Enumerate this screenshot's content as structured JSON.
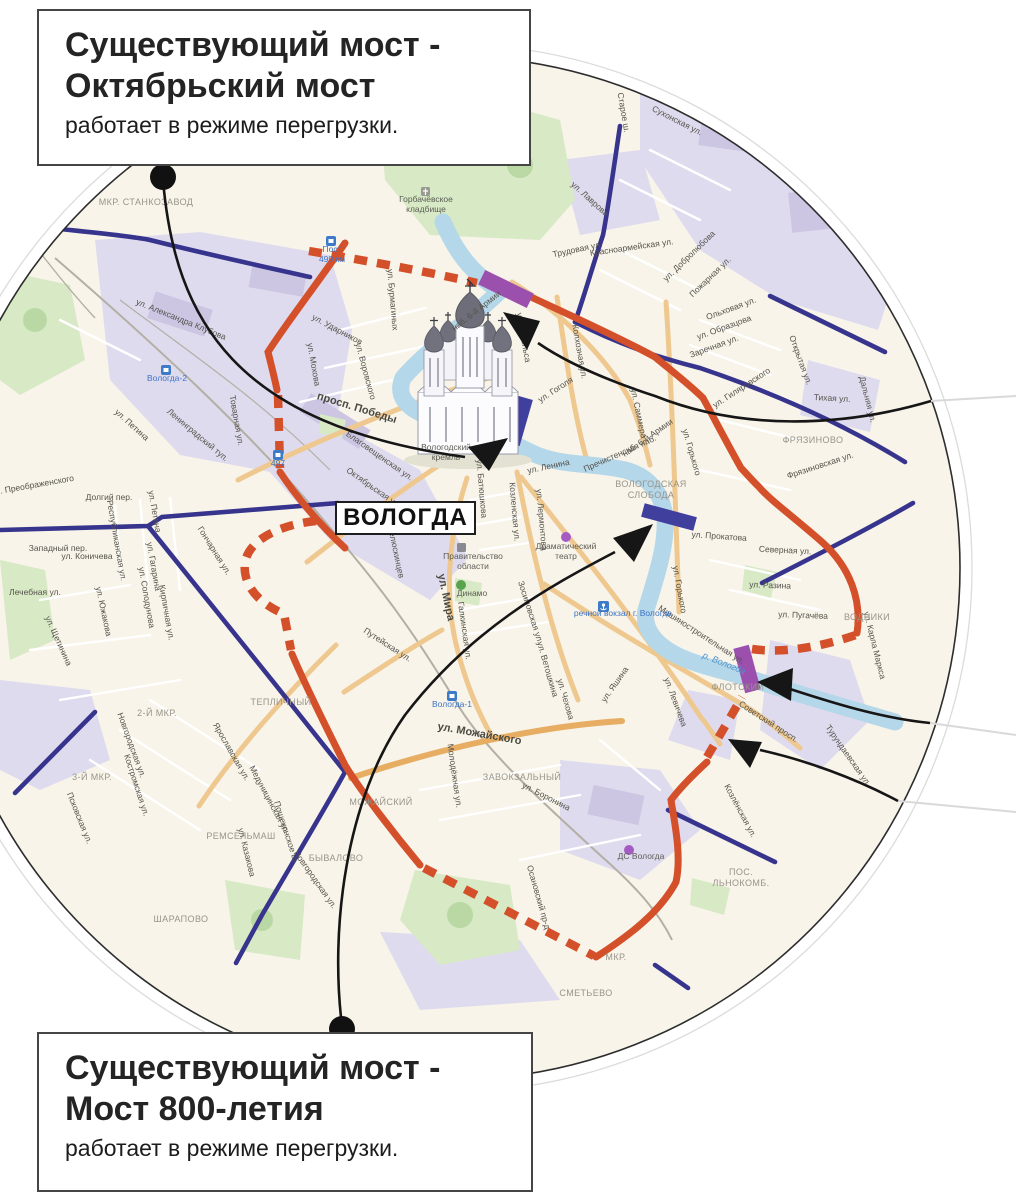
{
  "callouts": {
    "top": {
      "title_line1": "Существующий мост -",
      "title_line2": "Октябрьский мост",
      "body": "работает в режиме перегрузки."
    },
    "bottom": {
      "title_line1": "Существующий мост -",
      "title_line2": "Мост 800-летия",
      "body": "работает в режиме перегрузки."
    }
  },
  "city_label": "ВОЛОГДА",
  "colors": {
    "ring_road": "#d4502b",
    "secondary_road_blue": "#37348e",
    "new_bridge_purple": "#9c50ae",
    "existing_bridge_blue": "#413f9e",
    "river": "#b4d7e9",
    "land": "#f8f4e9",
    "industrial_zone": "#dfdbee",
    "park": "#d7e9c5",
    "annotation": "#161616"
  },
  "map_labels": [
    {
      "t": "ул. Александра Клубова",
      "x": 180,
      "y": 322,
      "r": 22,
      "c": "st"
    },
    {
      "t": "ул. Петина",
      "x": 130,
      "y": 427,
      "r": 42,
      "c": "st"
    },
    {
      "t": "Ленинградский туп.",
      "x": 196,
      "y": 437,
      "r": 40,
      "c": "st"
    },
    {
      "t": "Товарная ул.",
      "x": 234,
      "y": 421,
      "r": 80,
      "c": "st"
    },
    {
      "t": "ул. Бурмагиных",
      "x": 390,
      "y": 300,
      "r": 85,
      "c": "st"
    },
    {
      "t": "ул. Ударников",
      "x": 336,
      "y": 332,
      "r": 28,
      "c": "st"
    },
    {
      "t": "ул. Мохова",
      "x": 311,
      "y": 365,
      "r": 80,
      "c": "st"
    },
    {
      "t": "ул. Воровского",
      "x": 363,
      "y": 372,
      "r": 75,
      "c": "st"
    },
    {
      "t": "просп. Победы",
      "x": 356,
      "y": 411,
      "r": 17,
      "c": "stM"
    },
    {
      "t": "Благовещенская ул.",
      "x": 378,
      "y": 458,
      "r": 35,
      "c": "st"
    },
    {
      "t": "Октябрьская ул.",
      "x": 372,
      "y": 490,
      "r": 35,
      "c": "st"
    },
    {
      "t": "ул. Энгельса",
      "x": 521,
      "y": 338,
      "r": 80,
      "c": "st"
    },
    {
      "t": "Колхозная ул.",
      "x": 577,
      "y": 352,
      "r": 80,
      "c": "st"
    },
    {
      "t": "наб. 6-й Армии",
      "x": 478,
      "y": 313,
      "r": -38,
      "c": "st"
    },
    {
      "t": "наб. 6-й Армии",
      "x": 649,
      "y": 440,
      "r": -35,
      "c": "st"
    },
    {
      "t": "ул. Гоголя",
      "x": 557,
      "y": 392,
      "r": -33,
      "c": "st"
    },
    {
      "t": "ул. Саммера",
      "x": 636,
      "y": 414,
      "r": 78,
      "c": "st"
    },
    {
      "t": "ул. Ленина",
      "x": 549,
      "y": 469,
      "r": -12,
      "c": "st"
    },
    {
      "t": "Пречистенская наб.",
      "x": 621,
      "y": 456,
      "r": -24,
      "c": "st"
    },
    {
      "t": "ул. Лермонтова",
      "x": 539,
      "y": 520,
      "r": 85,
      "c": "st"
    },
    {
      "t": "ул. Батюшкова",
      "x": 479,
      "y": 489,
      "r": 85,
      "c": "st"
    },
    {
      "t": "Козленская ул.",
      "x": 512,
      "y": 512,
      "r": 85,
      "c": "st"
    },
    {
      "t": "ул. Челюскинцев",
      "x": 392,
      "y": 546,
      "r": 78,
      "c": "st"
    },
    {
      "t": "ул. Мира",
      "x": 443,
      "y": 598,
      "r": 78,
      "c": "stM"
    },
    {
      "t": "Галкинская ул.",
      "x": 462,
      "y": 631,
      "r": 82,
      "c": "st"
    },
    {
      "t": "Зосимовская ул.",
      "x": 528,
      "y": 613,
      "r": 72,
      "c": "st"
    },
    {
      "t": "Путейская ул.",
      "x": 386,
      "y": 647,
      "r": 33,
      "c": "st"
    },
    {
      "t": "ул. Ветошкина",
      "x": 545,
      "y": 670,
      "r": 74,
      "c": "st"
    },
    {
      "t": "ул. Чехова",
      "x": 563,
      "y": 700,
      "r": 74,
      "c": "st"
    },
    {
      "t": "ул. Яшина",
      "x": 617,
      "y": 686,
      "r": -55,
      "c": "st"
    },
    {
      "t": "ул. Левичева",
      "x": 673,
      "y": 703,
      "r": 70,
      "c": "st"
    },
    {
      "t": "ул. Горького",
      "x": 689,
      "y": 453,
      "r": 74,
      "c": "st"
    },
    {
      "t": "ул. Горького",
      "x": 677,
      "y": 590,
      "r": 80,
      "c": "st"
    },
    {
      "t": "ул. Прокатова",
      "x": 719,
      "y": 539,
      "r": 4,
      "c": "st"
    },
    {
      "t": "Северная ул.",
      "x": 785,
      "y": 553,
      "r": 3,
      "c": "st"
    },
    {
      "t": "ул. Разина",
      "x": 770,
      "y": 588,
      "r": 2,
      "c": "st"
    },
    {
      "t": "ул. Пугачёва",
      "x": 803,
      "y": 618,
      "r": 2,
      "c": "st"
    },
    {
      "t": "ул. Карла Маркса",
      "x": 872,
      "y": 646,
      "r": 76,
      "c": "st"
    },
    {
      "t": "Машиностроительная ул.",
      "x": 700,
      "y": 637,
      "r": 33,
      "c": "st"
    },
    {
      "t": "Советский просп.",
      "x": 767,
      "y": 724,
      "r": 33,
      "c": "st"
    },
    {
      "t": "Козлёнская ул.",
      "x": 738,
      "y": 812,
      "r": 62,
      "c": "st"
    },
    {
      "t": "Турундаевская ул.",
      "x": 846,
      "y": 757,
      "r": 55,
      "c": "st"
    },
    {
      "t": "ул. Лаврова",
      "x": 588,
      "y": 201,
      "r": 42,
      "c": "st"
    },
    {
      "t": "Старое ш.",
      "x": 621,
      "y": 113,
      "r": 80,
      "c": "st"
    },
    {
      "t": "Сухонская ул.",
      "x": 676,
      "y": 123,
      "r": 27,
      "c": "st"
    },
    {
      "t": "Красноармейская ул.",
      "x": 632,
      "y": 250,
      "r": -8,
      "c": "st"
    },
    {
      "t": "Трудовая ул.",
      "x": 578,
      "y": 252,
      "r": -12,
      "c": "st"
    },
    {
      "t": "ул. Добролюбова",
      "x": 691,
      "y": 258,
      "r": -44,
      "c": "st"
    },
    {
      "t": "Пожарная ул.",
      "x": 712,
      "y": 279,
      "r": -44,
      "c": "st"
    },
    {
      "t": "Ольховая ул.",
      "x": 732,
      "y": 311,
      "r": -20,
      "c": "st"
    },
    {
      "t": "ул. Образцова",
      "x": 725,
      "y": 330,
      "r": -20,
      "c": "st"
    },
    {
      "t": "Заречная ул.",
      "x": 715,
      "y": 349,
      "r": -20,
      "c": "st"
    },
    {
      "t": "Открытая ул.",
      "x": 798,
      "y": 361,
      "r": 70,
      "c": "st"
    },
    {
      "t": "Тихая ул.",
      "x": 832,
      "y": 401,
      "r": 3,
      "c": "st"
    },
    {
      "t": "Дальняя ул.",
      "x": 865,
      "y": 400,
      "r": 76,
      "c": "st"
    },
    {
      "t": "Фрязиновская ул.",
      "x": 821,
      "y": 468,
      "r": -18,
      "c": "st"
    },
    {
      "t": "ул. Гиляровского",
      "x": 743,
      "y": 390,
      "r": -33,
      "c": "st"
    },
    {
      "t": "ул. Можайского",
      "x": 479,
      "y": 737,
      "r": 10,
      "c": "stM"
    },
    {
      "t": "ул. Боронина",
      "x": 545,
      "y": 799,
      "r": 27,
      "c": "st"
    },
    {
      "t": "Молодёжная ул.",
      "x": 452,
      "y": 776,
      "r": 82,
      "c": "st"
    },
    {
      "t": "Осановский пр-д",
      "x": 536,
      "y": 898,
      "r": 74,
      "c": "st"
    },
    {
      "t": "Ярославская ул.",
      "x": 229,
      "y": 753,
      "r": 60,
      "c": "st"
    },
    {
      "t": "Новгородская ул.",
      "x": 129,
      "y": 746,
      "r": 70,
      "c": "st"
    },
    {
      "t": "Новгородская ул.",
      "x": 313,
      "y": 881,
      "r": 55,
      "c": "st"
    },
    {
      "t": "Костромская ул.",
      "x": 134,
      "y": 786,
      "r": 72,
      "c": "st"
    },
    {
      "t": "Псковская ул.",
      "x": 77,
      "y": 819,
      "r": 68,
      "c": "st"
    },
    {
      "t": "Медуницинская ул.",
      "x": 267,
      "y": 801,
      "r": 62,
      "c": "st"
    },
    {
      "t": "ул. Казакова",
      "x": 244,
      "y": 853,
      "r": 76,
      "c": "st"
    },
    {
      "t": "Пошехонское ш.",
      "x": 284,
      "y": 833,
      "r": 72,
      "c": "st"
    },
    {
      "t": "ул. Преображенского",
      "x": 33,
      "y": 488,
      "r": -10,
      "c": "st"
    },
    {
      "t": "Долгий пер.",
      "x": 109,
      "y": 500,
      "r": 0,
      "c": "st"
    },
    {
      "t": "Западный пер.",
      "x": 58,
      "y": 551,
      "r": 0,
      "c": "st"
    },
    {
      "t": "ул. Коничева",
      "x": 87,
      "y": 559,
      "r": 0,
      "c": "st"
    },
    {
      "t": "Республиканская ул.",
      "x": 114,
      "y": 541,
      "r": 80,
      "c": "st"
    },
    {
      "t": "Лечебная ул.",
      "x": 35,
      "y": 595,
      "r": 0,
      "c": "st"
    },
    {
      "t": "ул. Южакова",
      "x": 101,
      "y": 612,
      "r": 78,
      "c": "st"
    },
    {
      "t": "ул. Солодунова",
      "x": 144,
      "y": 598,
      "r": 80,
      "c": "st"
    },
    {
      "t": "Кирпичная ул.",
      "x": 164,
      "y": 613,
      "r": 80,
      "c": "st"
    },
    {
      "t": "ул. Гагарина",
      "x": 151,
      "y": 567,
      "r": 80,
      "c": "st"
    },
    {
      "t": "Гончарная ул.",
      "x": 212,
      "y": 552,
      "r": 58,
      "c": "st"
    },
    {
      "t": "ул. Щетинина",
      "x": 56,
      "y": 642,
      "r": 66,
      "c": "st"
    },
    {
      "t": "ул. Петина",
      "x": 152,
      "y": 512,
      "r": 80,
      "c": "st"
    },
    {
      "t": "МКР. СТАНКОЗАВОД",
      "x": 146,
      "y": 205,
      "r": 0,
      "c": "ds"
    },
    {
      "t": "ФРЯЗИНОВО",
      "x": 813,
      "y": 443,
      "r": 0,
      "c": "ds"
    },
    {
      "t": "ВОЛОГОДСКАЯ",
      "x": 651,
      "y": 487,
      "r": 0,
      "c": "ds"
    },
    {
      "t": "СЛОБОДА",
      "x": 651,
      "y": 498,
      "r": 0,
      "c": "ds"
    },
    {
      "t": "ВОДНИКИ",
      "x": 867,
      "y": 620,
      "r": 0,
      "c": "ds"
    },
    {
      "t": "ФЛОТСКИЙ",
      "x": 738,
      "y": 690,
      "r": 0,
      "c": "ds"
    },
    {
      "t": "ЗАВОКЗАЛЬНЫЙ",
      "x": 522,
      "y": 780,
      "r": 0,
      "c": "ds"
    },
    {
      "t": "МОЖАЙСКИЙ",
      "x": 381,
      "y": 805,
      "r": 0,
      "c": "ds"
    },
    {
      "t": "БЫВАЛОВО",
      "x": 336,
      "y": 861,
      "r": 0,
      "c": "ds"
    },
    {
      "t": "ТЕПЛИЧНЫЙ",
      "x": 281,
      "y": 705,
      "r": 0,
      "c": "ds"
    },
    {
      "t": "2-Й МКР.",
      "x": 157,
      "y": 716,
      "r": 0,
      "c": "ds"
    },
    {
      "t": "3-Й МКР.",
      "x": 92,
      "y": 780,
      "r": 0,
      "c": "ds"
    },
    {
      "t": "ШАРАПОВО",
      "x": 181,
      "y": 922,
      "r": 0,
      "c": "ds"
    },
    {
      "t": "РЕМСЕЛЬМАШ",
      "x": 241,
      "y": 839,
      "r": 0,
      "c": "ds"
    },
    {
      "t": "ПОС.",
      "x": 741,
      "y": 875,
      "r": 0,
      "c": "ds"
    },
    {
      "t": "ЛЬНОКОМБ.",
      "x": 741,
      "y": 886,
      "r": 0,
      "c": "ds"
    },
    {
      "t": "СМЕТЬЕВО",
      "x": 586,
      "y": 996,
      "r": 0,
      "c": "ds"
    },
    {
      "t": "МКР.",
      "x": 616,
      "y": 960,
      "r": 0,
      "c": "ds"
    },
    {
      "t": "Вологда-2",
      "x": 167,
      "y": 381,
      "r": 0,
      "c": "tr"
    },
    {
      "t": "Вологда-1",
      "x": 452,
      "y": 707,
      "r": 0,
      "c": "tr"
    },
    {
      "t": "497",
      "x": 278,
      "y": 466,
      "r": 0,
      "c": "tr"
    },
    {
      "t": "Пост",
      "x": 332,
      "y": 252,
      "r": 0,
      "c": "tr"
    },
    {
      "t": "499 км",
      "x": 332,
      "y": 262,
      "r": 0,
      "c": "tr"
    },
    {
      "t": "речной вокзал г. Вологда",
      "x": 623,
      "y": 616,
      "r": 0,
      "c": "tr"
    },
    {
      "t": "р. Вологда",
      "x": 723,
      "y": 666,
      "r": 22,
      "c": "wt"
    },
    {
      "t": "Горбачёвское",
      "x": 426,
      "y": 202,
      "r": 0,
      "c": "po"
    },
    {
      "t": "кладбище",
      "x": 426,
      "y": 212,
      "r": 0,
      "c": "po"
    },
    {
      "t": "Вологодский",
      "x": 446,
      "y": 450,
      "r": 0,
      "c": "po"
    },
    {
      "t": "кремль",
      "x": 446,
      "y": 460,
      "r": 0,
      "c": "po"
    },
    {
      "t": "Правительство",
      "x": 473,
      "y": 559,
      "r": 0,
      "c": "po"
    },
    {
      "t": "области",
      "x": 473,
      "y": 569,
      "r": 0,
      "c": "po"
    },
    {
      "t": "Динамо",
      "x": 472,
      "y": 596,
      "r": 0,
      "c": "po"
    },
    {
      "t": "Драматический",
      "x": 566,
      "y": 549,
      "r": 0,
      "c": "po"
    },
    {
      "t": "театр",
      "x": 566,
      "y": 559,
      "r": 0,
      "c": "po"
    },
    {
      "t": "ДС Вологда",
      "x": 641,
      "y": 859,
      "r": 0,
      "c": "po"
    }
  ]
}
